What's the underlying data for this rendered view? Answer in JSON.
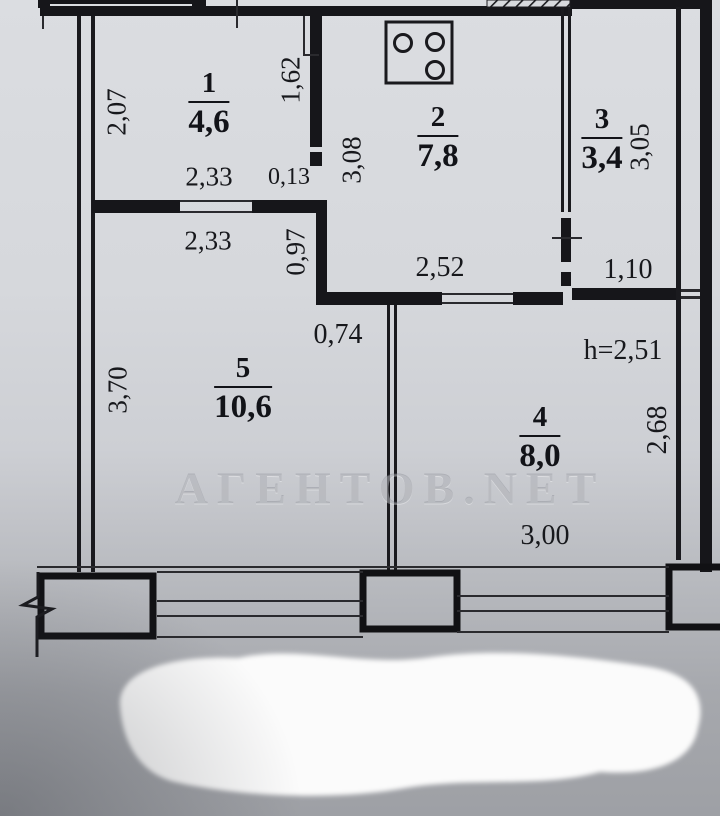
{
  "watermark": "АГЕНТОВ.NET",
  "rooms": [
    {
      "number": "1",
      "area": "4,6"
    },
    {
      "number": "2",
      "area": "7,8"
    },
    {
      "number": "3",
      "area": "3,4"
    },
    {
      "number": "4",
      "area": "8,0"
    },
    {
      "number": "5",
      "area": "10,6"
    }
  ],
  "dimensions": {
    "room1_height": "2,07",
    "kitchen_wall_upper": "1,62",
    "kitchen_height": "3,08",
    "room3_height": "3,05",
    "room1_width": "2,33",
    "wall_thickness": "0,13",
    "room5_top_width": "2,33",
    "corridor_height": "0,97",
    "kitchen_width": "2,52",
    "room3_width": "1,10",
    "corridor_width": "0,74",
    "room5_height": "3,70",
    "room4_height": "2,68",
    "room4_width": "3,00",
    "ceiling_height": "h=2,51"
  },
  "icons": {
    "stove": "stove-icon"
  }
}
